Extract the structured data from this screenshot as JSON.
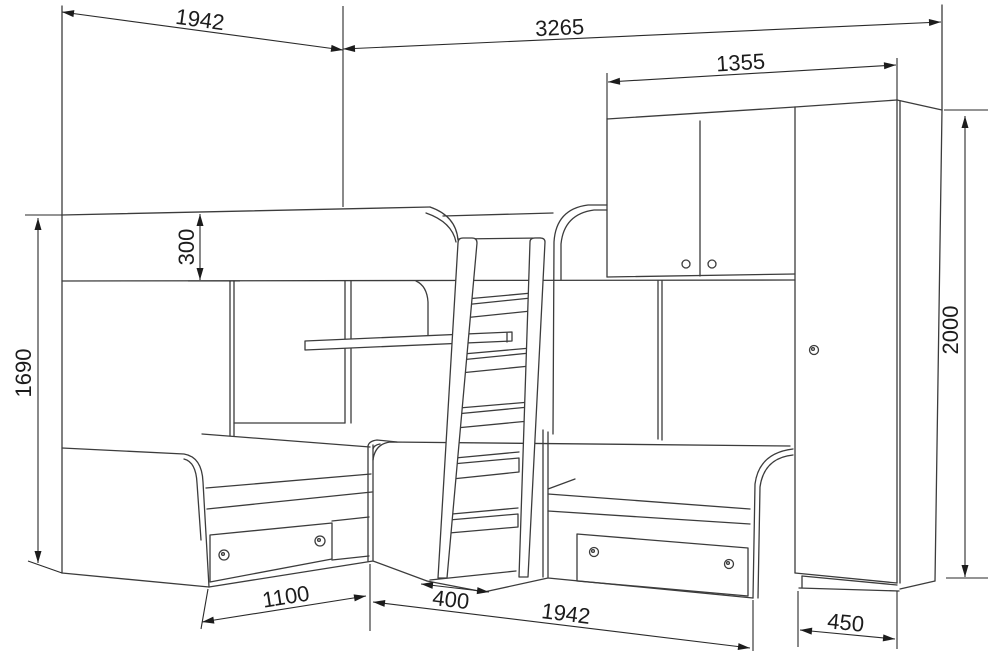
{
  "drawing": {
    "type": "furniture technical drawing",
    "subject": "corner bunk bed set with ladder, two-door overhead cabinet and wardrobe",
    "units": "mm",
    "colors": {
      "background": "#ffffff",
      "line": "#3c3c3c",
      "dimension_text": "#1c1c1c"
    },
    "dimensions": {
      "top_left_width": "1942",
      "total_width": "3265",
      "cabinet_and_wardrobe_width": "1355",
      "wardrobe_height": "2000",
      "bed_back_height": "1690",
      "guard_rail_height": "300",
      "left_bed_footprint": "1100",
      "ladder_footprint": "400",
      "right_bed_length": "1942",
      "wardrobe_width": "450"
    }
  }
}
